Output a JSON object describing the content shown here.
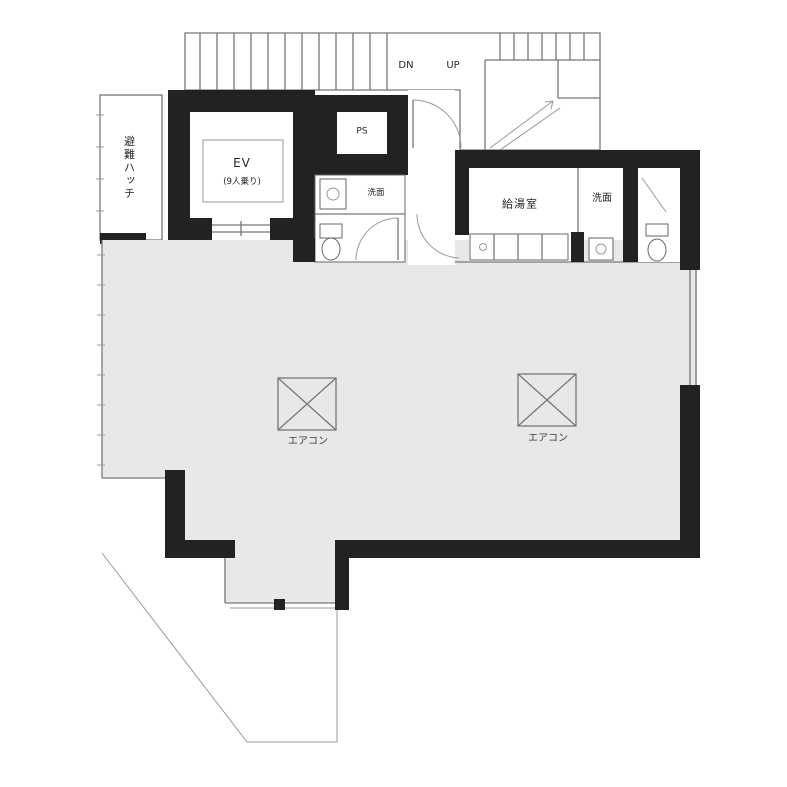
{
  "plan_type": "floor-plan",
  "labels": {
    "balcony": "避難ハッチ",
    "elevator": "EV",
    "elevator_capacity": "(9人乗り)",
    "pipe_space": "PS",
    "washroom": "洗面",
    "kitchenette": "給湯室",
    "powder_room": "洗面",
    "stair_down": "DN",
    "stair_up": "UP",
    "aircon_left": "エアコン",
    "aircon_right": "エアコン"
  },
  "colors": {
    "wall": "#222222",
    "floor_fill": "#e8e9e6",
    "thin_line": "#777777",
    "background": "#ffffff"
  }
}
